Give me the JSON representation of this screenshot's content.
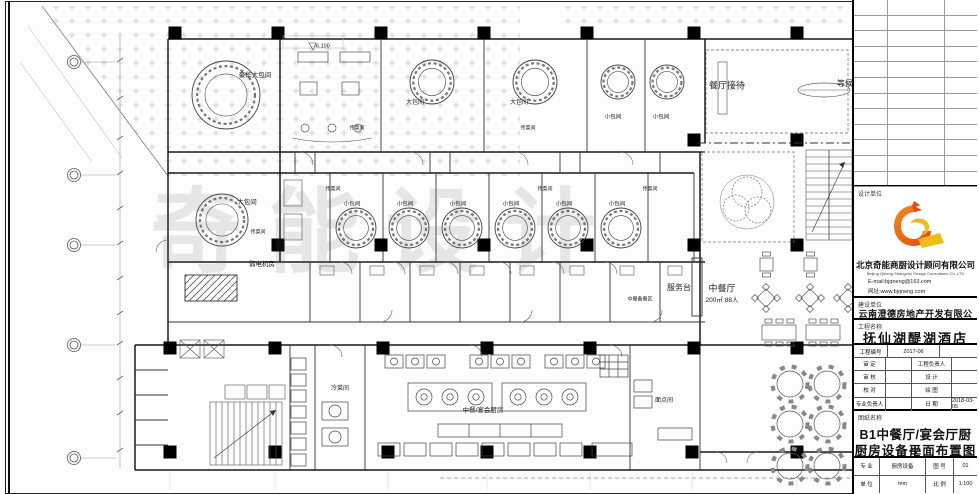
{
  "page": {
    "watermark": "奇能设计"
  },
  "plan": {
    "labels": [
      {
        "t": "-6.100",
        "x": 322,
        "y": 47,
        "s": 5.5
      },
      {
        "t": "豪华大包间",
        "x": 255,
        "y": 76,
        "s": 6.5
      },
      {
        "t": "大包间",
        "x": 415,
        "y": 103,
        "s": 6
      },
      {
        "t": "大包间",
        "x": 519,
        "y": 103,
        "s": 6
      },
      {
        "t": "小包间",
        "x": 613,
        "y": 118,
        "s": 5.5
      },
      {
        "t": "小包间",
        "x": 661,
        "y": 118,
        "s": 5.5
      },
      {
        "t": "餐厅接待",
        "x": 727,
        "y": 86,
        "s": 9
      },
      {
        "t": "等候",
        "x": 845,
        "y": 84,
        "s": 8
      },
      {
        "t": "传菜间",
        "x": 357,
        "y": 129,
        "s": 5
      },
      {
        "t": "传菜间",
        "x": 528,
        "y": 129,
        "s": 5
      },
      {
        "t": "大包间",
        "x": 247,
        "y": 203,
        "s": 6.5
      },
      {
        "t": "传菜间",
        "x": 258,
        "y": 233,
        "s": 5
      },
      {
        "t": "传菜间",
        "x": 333,
        "y": 190,
        "s": 5
      },
      {
        "t": "传菜间",
        "x": 545,
        "y": 190,
        "s": 5
      },
      {
        "t": "传菜间",
        "x": 650,
        "y": 190,
        "s": 5
      },
      {
        "t": "小包间",
        "x": 352,
        "y": 205,
        "s": 5.5
      },
      {
        "t": "小包间",
        "x": 405,
        "y": 205,
        "s": 5.5
      },
      {
        "t": "小包间",
        "x": 458,
        "y": 205,
        "s": 5.5
      },
      {
        "t": "小包间",
        "x": 511,
        "y": 205,
        "s": 5.5
      },
      {
        "t": "小包间",
        "x": 564,
        "y": 205,
        "s": 5.5
      },
      {
        "t": "小包间",
        "x": 617,
        "y": 205,
        "s": 5.5
      },
      {
        "t": "弱电机房",
        "x": 262,
        "y": 265,
        "s": 6.5
      },
      {
        "t": "服务台",
        "x": 679,
        "y": 288,
        "s": 8
      },
      {
        "t": "中餐厅",
        "x": 722,
        "y": 289,
        "s": 9
      },
      {
        "t": "200㎡ 88人",
        "x": 722,
        "y": 301,
        "s": 6.5
      },
      {
        "t": "中餐备餐区",
        "x": 640,
        "y": 300,
        "s": 5
      },
      {
        "t": "冷菜间",
        "x": 340,
        "y": 389,
        "s": 6
      },
      {
        "t": "中餐/宴会厨房",
        "x": 483,
        "y": 411,
        "s": 6.5
      },
      {
        "t": "面点间",
        "x": 664,
        "y": 401,
        "s": 6
      }
    ]
  },
  "titleblock": {
    "design_unit_label": "设计单位",
    "company_cn": "北京奇能商厨设计顾问有限公司",
    "company_en": "Beijing Qineng Shangchu Design Consultants Co.,LTD",
    "email": "E-mail:bjqneng@163.com",
    "website": "网址:www.bjqneng.com",
    "build_unit_label": "建设单位",
    "build_unit": "云南澄德房地产开发有限公司",
    "project_label": "工程名称",
    "project_name": "抚仙湖醍湖酒店",
    "project_no_label": "工程编号",
    "project_no": "2017-06",
    "rows": [
      {
        "l": "审 定",
        "v": "",
        "l2": "工程负责人",
        "v2": ""
      },
      {
        "l": "审 核",
        "v": "",
        "l2": "设 计",
        "v2": ""
      },
      {
        "l": "校 对",
        "v": "",
        "l2": "绘 图",
        "v2": ""
      },
      {
        "l": "专业负责人",
        "v": "",
        "l2": "日 期",
        "v2": "2018-03-05"
      }
    ],
    "sheet_label": "图纸名称",
    "sheet_name_1": "B1中餐厅/宴会厅厨房",
    "sheet_name_2": "厨房设备平面布置图",
    "bottom_rows": [
      {
        "l": "专 业",
        "v": "厨房设备",
        "l2": "图 号",
        "v2": "01"
      },
      {
        "l": "单 位",
        "v": "mm",
        "l2": "比 例",
        "v2": "1:100"
      }
    ],
    "logo_colors": {
      "red": "#e04a12",
      "orange": "#f08a1d",
      "yellow": "#e8c41a"
    }
  }
}
